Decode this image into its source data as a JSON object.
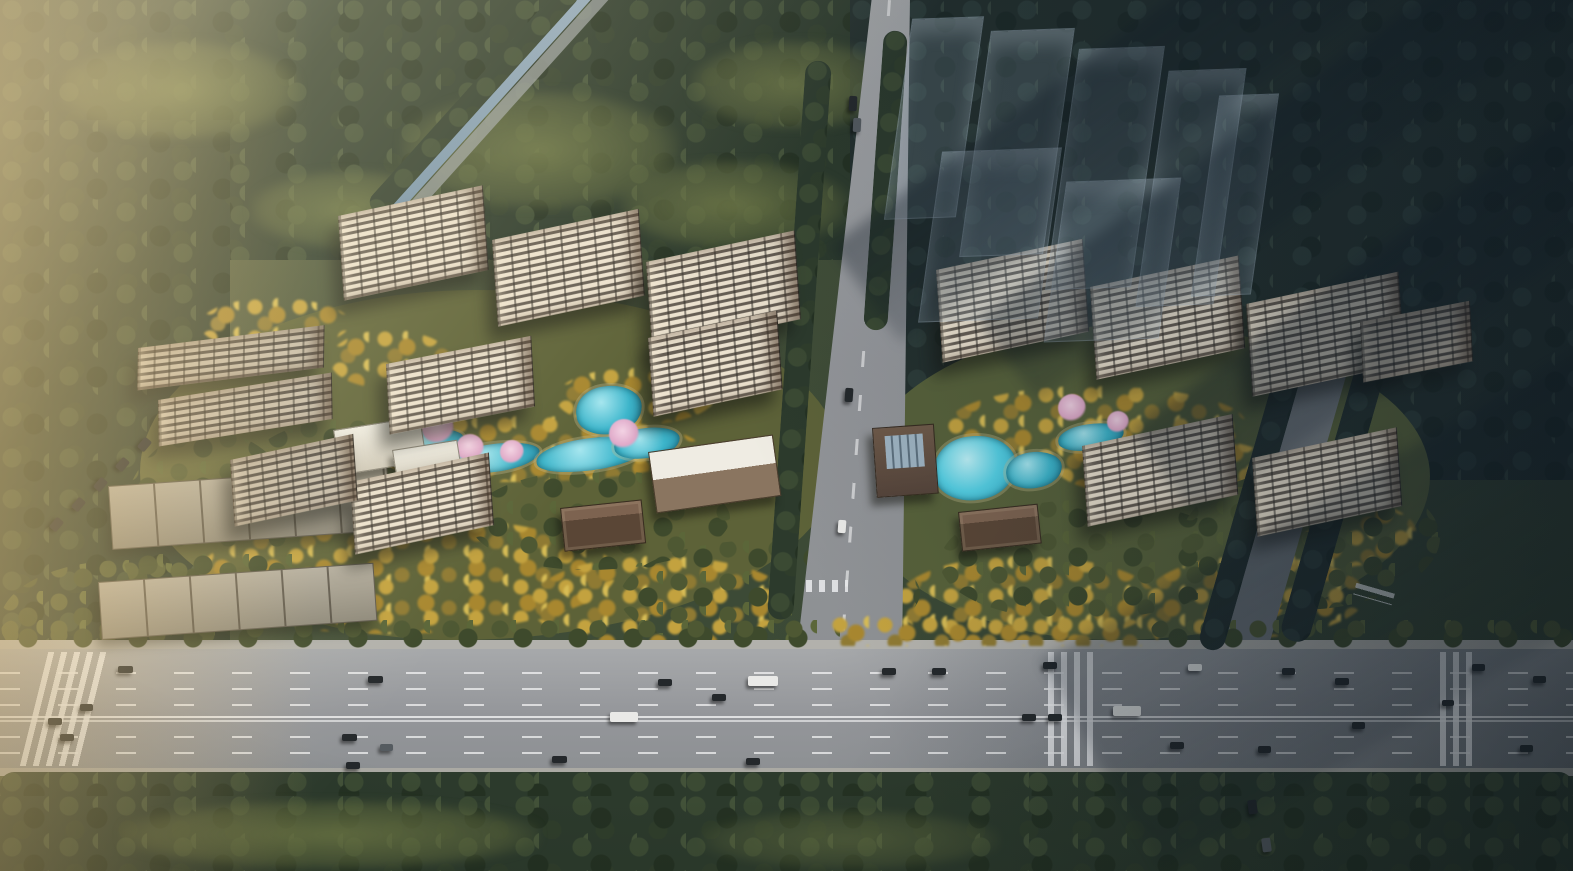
{
  "scene": {
    "title": "Aerial masterplan rendering of a residential development: two clusters of high-rise apartment towers with landscaped courtyards, ponds and golden trees, bordered by forest, a central access road and a wide multi-lane highway with vehicles along the bottom; translucent future buildings cast shadows at top right",
    "type": "aerial-architectural-render",
    "canvas": {
      "width": 1573,
      "height": 871
    }
  },
  "palette": {
    "forest_green": "#2c3a2c",
    "forest_blue_shade": "#232f2d",
    "olive_ground": "#5d6238",
    "gold_foliage": "#c3a23f",
    "roof_brown": "#5d4c41",
    "facade_cream": "#ece2cf",
    "pool_teal": "#3db6cc",
    "pool_cyan": "#55d0e4",
    "road_gray": "#97999c",
    "lane_marking_white": "#ffffff",
    "blossom_pink": "#dfa8c8",
    "haze_warm": "#f0dca0",
    "shadow_cool": "#101a24"
  },
  "towers": [
    {
      "x": 338,
      "y": 216,
      "w": 148,
      "roof": 34,
      "fac": 84,
      "rot": -12,
      "v": ""
    },
    {
      "x": 492,
      "y": 240,
      "w": 150,
      "roof": 34,
      "fac": 86,
      "rot": -12,
      "v": ""
    },
    {
      "x": 646,
      "y": 262,
      "w": 152,
      "roof": 36,
      "fac": 88,
      "rot": -12,
      "v": ""
    },
    {
      "x": 138,
      "y": 348,
      "w": 188,
      "roof": 26,
      "fac": 42,
      "rot": -7,
      "v": "dim"
    },
    {
      "x": 158,
      "y": 400,
      "w": 176,
      "roof": 26,
      "fac": 46,
      "rot": -9,
      "v": "dim"
    },
    {
      "x": 386,
      "y": 364,
      "w": 148,
      "roof": 32,
      "fac": 70,
      "rot": -11,
      "v": ""
    },
    {
      "x": 648,
      "y": 338,
      "w": 132,
      "roof": 32,
      "fac": 78,
      "rot": -12,
      "v": ""
    },
    {
      "x": 350,
      "y": 482,
      "w": 142,
      "roof": 30,
      "fac": 72,
      "rot": -12,
      "v": ""
    },
    {
      "x": 230,
      "y": 460,
      "w": 126,
      "roof": 28,
      "fac": 66,
      "rot": -12,
      "v": "dim"
    },
    {
      "x": 936,
      "y": 270,
      "w": 150,
      "roof": 36,
      "fac": 92,
      "rot": -12,
      "v": ""
    },
    {
      "x": 1090,
      "y": 287,
      "w": 152,
      "roof": 36,
      "fac": 92,
      "rot": -12,
      "v": ""
    },
    {
      "x": 1246,
      "y": 304,
      "w": 156,
      "roof": 36,
      "fac": 92,
      "rot": -12,
      "v": ""
    },
    {
      "x": 1082,
      "y": 446,
      "w": 154,
      "roof": 32,
      "fac": 80,
      "rot": -12,
      "v": ""
    },
    {
      "x": 1252,
      "y": 458,
      "w": 148,
      "roof": 32,
      "fac": 78,
      "rot": -12,
      "v": ""
    },
    {
      "x": 1360,
      "y": 322,
      "w": 112,
      "roof": 28,
      "fac": 60,
      "rot": -11,
      "v": "dim"
    }
  ],
  "lowrise": [
    {
      "x": 108,
      "y": 486,
      "w": 280,
      "h": 64,
      "rot": -4
    },
    {
      "x": 98,
      "y": 582,
      "w": 276,
      "h": 58,
      "rot": -4
    }
  ],
  "amenities": [
    {
      "x": 333,
      "y": 430,
      "w": 88,
      "h": 46,
      "rot": -9,
      "v": "white-amen",
      "name": "amenity-pavilion"
    },
    {
      "x": 392,
      "y": 450,
      "w": 66,
      "h": 36,
      "rot": -9,
      "v": "white-amen",
      "name": "amenity-pavilion"
    },
    {
      "x": 408,
      "y": 477,
      "w": 56,
      "h": 30,
      "rot": -7,
      "v": "gate",
      "name": "courtyard-gate"
    },
    {
      "x": 648,
      "y": 452,
      "w": 126,
      "h": 62,
      "rot": -8,
      "v": "club",
      "name": "clubhouse"
    },
    {
      "x": 560,
      "y": 508,
      "w": 82,
      "h": 44,
      "rot": -6,
      "v": "gate",
      "name": "south-entry-gate"
    },
    {
      "x": 872,
      "y": 428,
      "w": 62,
      "h": 70,
      "rot": -4,
      "v": "club2",
      "name": "clubhouse-skylight"
    },
    {
      "x": 958,
      "y": 512,
      "w": 80,
      "h": 40,
      "rot": -6,
      "v": "gate",
      "name": "south-entry-gate"
    }
  ],
  "pools": [
    {
      "x": 398,
      "y": 430,
      "w": 66,
      "h": 26,
      "v": ""
    },
    {
      "x": 448,
      "y": 444,
      "w": 92,
      "h": 28,
      "v": ""
    },
    {
      "x": 536,
      "y": 438,
      "w": 112,
      "h": 32,
      "v": ""
    },
    {
      "x": 576,
      "y": 386,
      "w": 66,
      "h": 48,
      "v": ""
    },
    {
      "x": 614,
      "y": 428,
      "w": 66,
      "h": 30,
      "v": ""
    },
    {
      "x": 934,
      "y": 436,
      "w": 82,
      "h": 64,
      "v": "bright"
    },
    {
      "x": 1006,
      "y": 452,
      "w": 56,
      "h": 36,
      "v": ""
    },
    {
      "x": 1058,
      "y": 424,
      "w": 66,
      "h": 26,
      "v": ""
    },
    {
      "x": 1108,
      "y": 440,
      "w": 44,
      "h": 22,
      "v": ""
    }
  ],
  "blossoms": [
    {
      "x": 438,
      "y": 428,
      "r": 16
    },
    {
      "x": 470,
      "y": 448,
      "r": 14
    },
    {
      "x": 512,
      "y": 452,
      "r": 12
    },
    {
      "x": 624,
      "y": 434,
      "r": 15
    },
    {
      "x": 900,
      "y": 464,
      "r": 12
    },
    {
      "x": 1072,
      "y": 408,
      "r": 14
    },
    {
      "x": 1118,
      "y": 422,
      "r": 11
    }
  ],
  "ghost_buildings": [
    {
      "x": 898,
      "y": 18,
      "w": 72,
      "h": 200
    },
    {
      "x": 975,
      "y": 30,
      "w": 84,
      "h": 225
    },
    {
      "x": 1062,
      "y": 48,
      "w": 86,
      "h": 240
    },
    {
      "x": 1152,
      "y": 70,
      "w": 78,
      "h": 235
    },
    {
      "x": 930,
      "y": 150,
      "w": 120,
      "h": 170
    },
    {
      "x": 1055,
      "y": 180,
      "w": 115,
      "h": 160
    },
    {
      "x": 1205,
      "y": 95,
      "w": 60,
      "h": 200
    }
  ],
  "vehicles": [
    {
      "x": 118,
      "y": 666,
      "w": 15,
      "h": 7,
      "c": "d",
      "rot": 0
    },
    {
      "x": 368,
      "y": 676,
      "w": 15,
      "h": 7,
      "c": "d",
      "rot": 0
    },
    {
      "x": 658,
      "y": 679,
      "w": 14,
      "h": 7,
      "c": "d",
      "rot": 0
    },
    {
      "x": 712,
      "y": 694,
      "w": 14,
      "h": 7,
      "c": "d",
      "rot": 0
    },
    {
      "x": 748,
      "y": 676,
      "w": 30,
      "h": 10,
      "c": "w",
      "rot": 0
    },
    {
      "x": 882,
      "y": 668,
      "w": 14,
      "h": 7,
      "c": "d",
      "rot": 0
    },
    {
      "x": 932,
      "y": 668,
      "w": 14,
      "h": 7,
      "c": "d",
      "rot": 0
    },
    {
      "x": 1043,
      "y": 662,
      "w": 14,
      "h": 7,
      "c": "d",
      "rot": 0
    },
    {
      "x": 1188,
      "y": 664,
      "w": 14,
      "h": 7,
      "c": "w",
      "rot": 0
    },
    {
      "x": 1282,
      "y": 668,
      "w": 13,
      "h": 7,
      "c": "d",
      "rot": 0
    },
    {
      "x": 1335,
      "y": 678,
      "w": 14,
      "h": 7,
      "c": "d",
      "rot": 0
    },
    {
      "x": 1472,
      "y": 664,
      "w": 13,
      "h": 7,
      "c": "d",
      "rot": 0
    },
    {
      "x": 1533,
      "y": 676,
      "w": 13,
      "h": 7,
      "c": "d",
      "rot": 0
    },
    {
      "x": 48,
      "y": 718,
      "w": 14,
      "h": 7,
      "c": "d",
      "rot": 0
    },
    {
      "x": 60,
      "y": 734,
      "w": 14,
      "h": 7,
      "c": "d",
      "rot": 0
    },
    {
      "x": 80,
      "y": 704,
      "w": 13,
      "h": 7,
      "c": "d",
      "rot": 0
    },
    {
      "x": 342,
      "y": 734,
      "w": 15,
      "h": 7,
      "c": "d",
      "rot": 0
    },
    {
      "x": 346,
      "y": 762,
      "w": 14,
      "h": 7,
      "c": "d",
      "rot": 0
    },
    {
      "x": 380,
      "y": 744,
      "w": 13,
      "h": 7,
      "c": "g",
      "rot": 0
    },
    {
      "x": 552,
      "y": 756,
      "w": 15,
      "h": 7,
      "c": "d",
      "rot": 0
    },
    {
      "x": 610,
      "y": 712,
      "w": 28,
      "h": 10,
      "c": "w",
      "rot": 0
    },
    {
      "x": 746,
      "y": 758,
      "w": 14,
      "h": 7,
      "c": "d",
      "rot": 0
    },
    {
      "x": 1022,
      "y": 714,
      "w": 14,
      "h": 7,
      "c": "d",
      "rot": 0
    },
    {
      "x": 1048,
      "y": 714,
      "w": 14,
      "h": 7,
      "c": "d",
      "rot": 0
    },
    {
      "x": 1113,
      "y": 706,
      "w": 28,
      "h": 10,
      "c": "w",
      "rot": 0
    },
    {
      "x": 1170,
      "y": 742,
      "w": 14,
      "h": 7,
      "c": "d",
      "rot": 0
    },
    {
      "x": 1258,
      "y": 746,
      "w": 13,
      "h": 7,
      "c": "d",
      "rot": 0
    },
    {
      "x": 1352,
      "y": 722,
      "w": 13,
      "h": 7,
      "c": "d",
      "rot": 0
    },
    {
      "x": 1442,
      "y": 700,
      "w": 12,
      "h": 6,
      "c": "d",
      "rot": 0
    },
    {
      "x": 1520,
      "y": 745,
      "w": 13,
      "h": 7,
      "c": "d",
      "rot": 0
    },
    {
      "x": 849,
      "y": 96,
      "w": 8,
      "h": 15,
      "c": "d",
      "rot": 3
    },
    {
      "x": 853,
      "y": 118,
      "w": 8,
      "h": 14,
      "c": "g",
      "rot": 3
    },
    {
      "x": 845,
      "y": 388,
      "w": 8,
      "h": 14,
      "c": "d",
      "rot": 4
    },
    {
      "x": 838,
      "y": 520,
      "w": 8,
      "h": 13,
      "c": "w",
      "rot": 4
    },
    {
      "x": 52,
      "y": 518,
      "w": 9,
      "h": 13,
      "c": "d",
      "rot": 40
    },
    {
      "x": 74,
      "y": 498,
      "w": 9,
      "h": 13,
      "c": "d",
      "rot": 40
    },
    {
      "x": 96,
      "y": 478,
      "w": 9,
      "h": 13,
      "c": "d",
      "rot": 40
    },
    {
      "x": 118,
      "y": 458,
      "w": 9,
      "h": 13,
      "c": "d",
      "rot": 40
    },
    {
      "x": 140,
      "y": 438,
      "w": 9,
      "h": 13,
      "c": "d",
      "rot": 40
    },
    {
      "x": 1248,
      "y": 800,
      "w": 9,
      "h": 14,
      "c": "d",
      "rot": -8
    },
    {
      "x": 1262,
      "y": 838,
      "w": 9,
      "h": 14,
      "c": "g",
      "rot": -8
    }
  ],
  "vehicle_colors": {
    "d": "#24282b",
    "w": "#e9e9e7",
    "g": "#555b60"
  },
  "roads": {
    "highway": {
      "x": 0,
      "y": 648,
      "w": 1573,
      "h": 122,
      "lanes": 7,
      "median_y": 716,
      "crosswalks_x": [
        34,
        1048,
        1440
      ]
    },
    "central_access_road": {
      "top_x": 872,
      "bottom_x": 798,
      "top_y": 0,
      "bottom_y": 660
    },
    "east_road_upper": {
      "x": 1320,
      "y": 300,
      "w": 46,
      "h": 370,
      "rot": 16
    },
    "east_road_lower": {
      "x": 1238,
      "y": 768,
      "w": 62,
      "h": 103,
      "rot": -11
    },
    "east_spur": {
      "x": 1295,
      "y": 792,
      "w": 278,
      "h": 40
    },
    "canal_northwest": {
      "from": [
        600,
        0
      ],
      "to": [
        388,
        200
      ]
    }
  }
}
